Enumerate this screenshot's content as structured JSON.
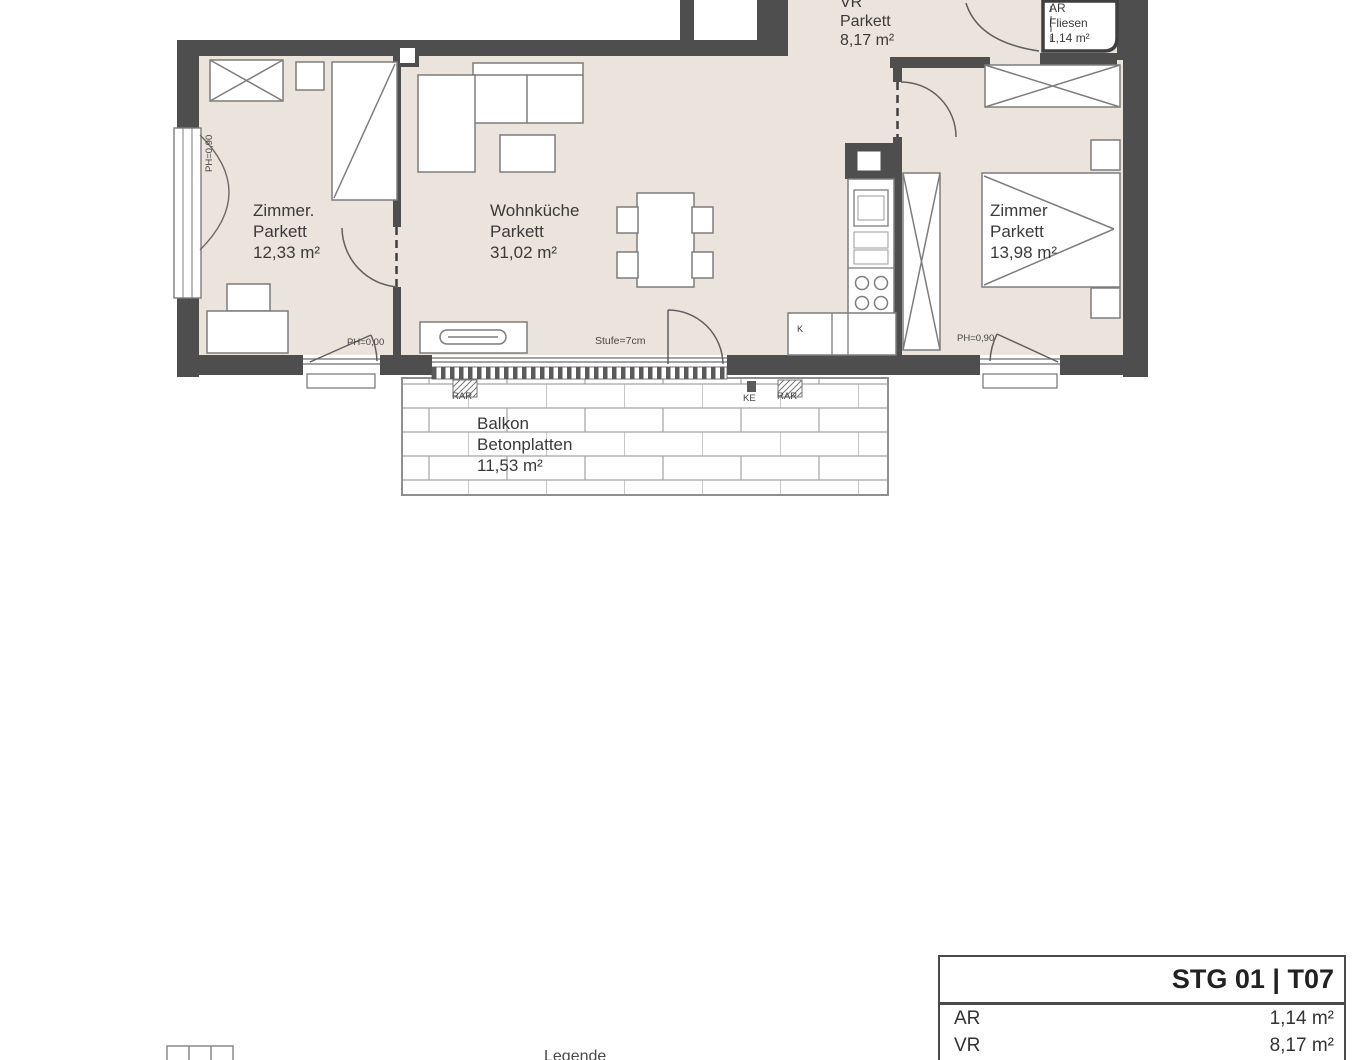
{
  "plan": {
    "rooms": [
      {
        "id": "zimmer-left",
        "name": "Zimmer.",
        "floor": "Parkett",
        "area": "12,33 m²"
      },
      {
        "id": "wohnkueche",
        "name": "Wohnküche",
        "floor": "Parkett",
        "area": "31,02 m²"
      },
      {
        "id": "vr",
        "name": "VR",
        "floor": "Parkett",
        "area": "8,17 m²"
      },
      {
        "id": "ar",
        "name": "AR",
        "floor": "Fliesen",
        "area": "1,14 m²"
      },
      {
        "id": "zimmer-right",
        "name": "Zimmer",
        "floor": "Parkett",
        "area": "13,98 m²"
      },
      {
        "id": "balkon",
        "name": "Balkon",
        "floor": "Betonplatten",
        "area": "11,53 m²"
      }
    ],
    "annotations": {
      "step_label": "Stufe=7cm",
      "ph_left_wall_window": "PH=0,90",
      "ph_left_bottom_window": "PH=0,00",
      "ph_right_bottom_window": "PH=0,90",
      "kitchen_cabinet": "K",
      "marker_rar_left": "RAR",
      "marker_ke": "KE",
      "marker_rar_right": "RAR"
    },
    "colors": {
      "wall": "#4e4e4e",
      "floor": "#ebe4dd",
      "furniture_stroke": "#7d7d7d",
      "text": "#3a3a3a"
    }
  },
  "info_table": {
    "title": "STG 01 | T07",
    "rows": [
      {
        "label": "AR",
        "value": "1,14 m²"
      },
      {
        "label": "VR",
        "value": "8,17 m²"
      }
    ]
  },
  "legend": {
    "title": "Legende"
  }
}
